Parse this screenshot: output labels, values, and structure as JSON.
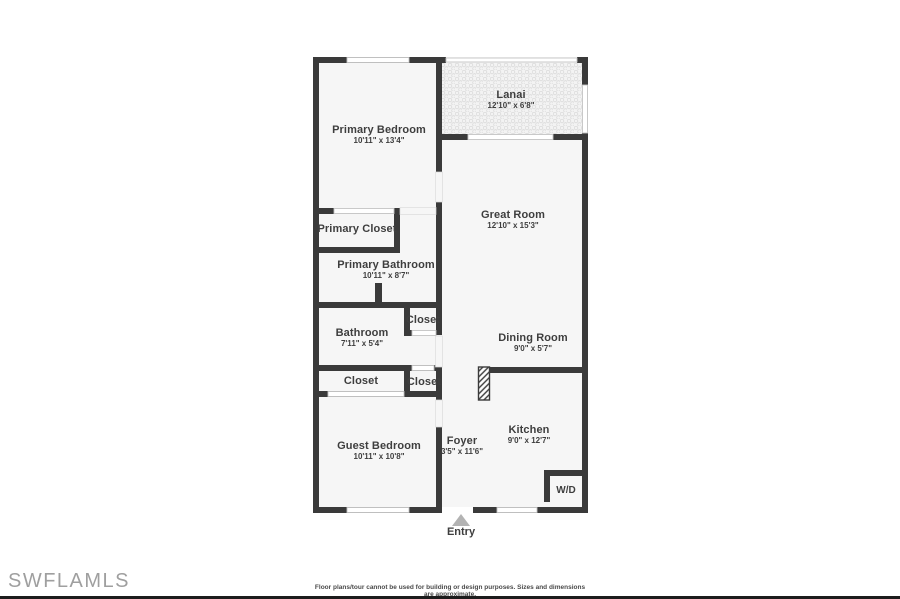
{
  "plan": {
    "rooms": {
      "primary_bedroom": {
        "name": "Primary Bedroom",
        "dims": "10'11\" x 13'4\""
      },
      "lanai": {
        "name": "Lanai",
        "dims": "12'10\" x 6'8\""
      },
      "great_room": {
        "name": "Great Room",
        "dims": "12'10\" x 15'3\""
      },
      "primary_closet": {
        "name": "Primary Closet"
      },
      "primary_bathroom": {
        "name": "Primary Bathroom",
        "dims": "10'11\" x 8'7\""
      },
      "bathroom": {
        "name": "Bathroom",
        "dims": "7'11\" x 5'4\""
      },
      "closet_hall": {
        "name": "Closet"
      },
      "dining_room": {
        "name": "Dining Room",
        "dims": "9'0\" x 5'7\""
      },
      "closet_guest": {
        "name": "Closet"
      },
      "closet_foyer": {
        "name": "Closet"
      },
      "guest_bedroom": {
        "name": "Guest Bedroom",
        "dims": "10'11\" x 10'8\""
      },
      "foyer": {
        "name": "Foyer",
        "dims": "3'5\" x 11'6\""
      },
      "kitchen": {
        "name": "Kitchen",
        "dims": "9'0\" x 12'7\""
      },
      "wd": {
        "name": "W/D"
      }
    },
    "entry_label": "Entry"
  },
  "footer": {
    "watermark": "SWFLAMLS",
    "disclaimer": "Floor plans/tour cannot be used for building or design purposes. Sizes and dimensions are approximate."
  },
  "colors": {
    "wall": "#3a3a3a",
    "room_fill": "#f6f6f6",
    "window_line": "#c4c4c4",
    "lanai_pattern": "#d9d9d9",
    "entry_arrow": "#b3b3b3",
    "text": "#3e3e3e",
    "watermark": "#8f8f8f",
    "bottom_bar": "#1c1c1c"
  }
}
